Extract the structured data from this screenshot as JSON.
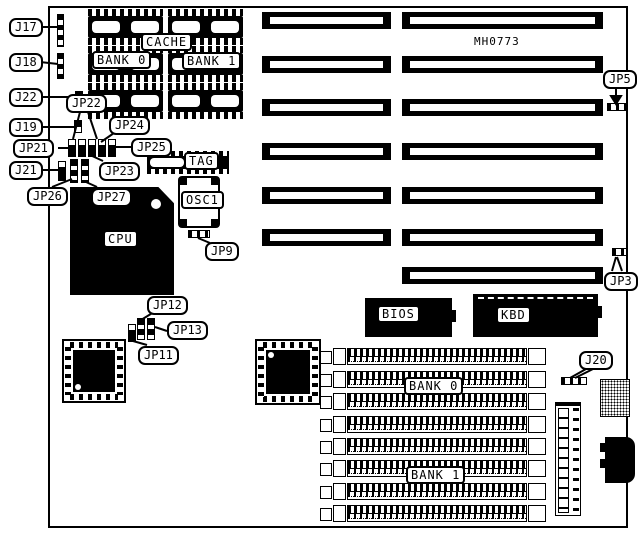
{
  "diagram": {
    "board_id": "MH0773"
  },
  "callouts": {
    "j17": "J17",
    "j18": "J18",
    "j22": "J22",
    "j19": "J19",
    "jp21": "JP21",
    "j21": "J21",
    "jp26": "JP26",
    "jp22": "JP22",
    "jp24": "JP24",
    "jp25": "JP25",
    "jp23": "JP23",
    "jp27": "JP27",
    "jp9": "JP9",
    "jp12": "JP12",
    "jp13": "JP13",
    "jp11": "JP11",
    "jp5": "JP5",
    "jp3": "JP3",
    "j20": "J20"
  },
  "components": {
    "cache": "CACHE",
    "cache_bank0": "BANK 0",
    "cache_bank1": "BANK 1",
    "tag": "TAG",
    "osc1": "OSC1",
    "cpu": "CPU",
    "bios": "BIOS",
    "kbd": "KBD",
    "simm_bank0": "BANK 0",
    "simm_bank1": "BANK 1"
  },
  "colors": {
    "ink": "#000000",
    "paper": "#ffffff"
  }
}
